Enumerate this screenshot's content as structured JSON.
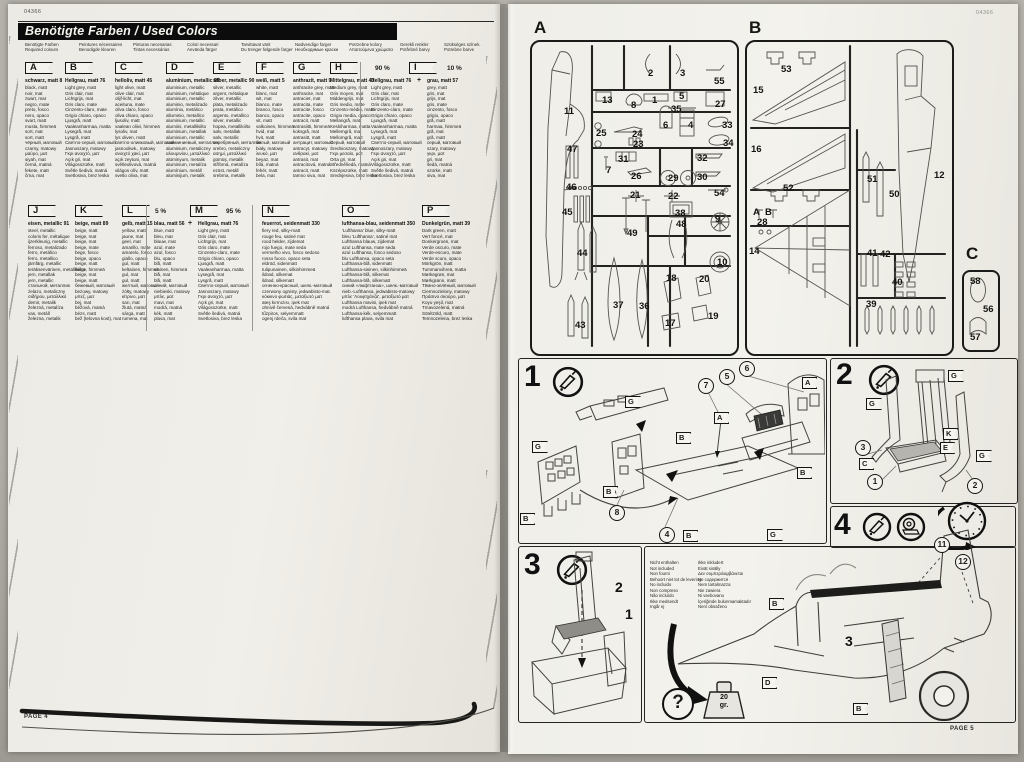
{
  "codes": {
    "left": "04366",
    "right": "04366"
  },
  "footers": {
    "left": "PAGE 4",
    "right": "PAGE 5"
  },
  "banner": {
    "title": "Benötigte Farben / Used Colors"
  },
  "header_labels": [
    {
      "a": "Benötigte Farben",
      "b": "Required colours"
    },
    {
      "a": "Peintures nécessaires",
      "b": "Benodigde kleuren"
    },
    {
      "a": "Pinturas necesarias",
      "b": "Tintas necessárias"
    },
    {
      "a": "Colori necessari",
      "b": "Använda färger"
    },
    {
      "a": "Tarvittavat värit",
      "b": "Du trenger følgende farger"
    },
    {
      "a": "Nødvendige farger",
      "b": "Необходимые краски"
    },
    {
      "a": "Potrzebne kolory",
      "b": "Απαιτούμενα χρώματα"
    },
    {
      "a": "Gerekli renkler",
      "b": "Potřebné barvy"
    },
    {
      "a": "Szükséges színek.",
      "b": "Potrebne barve"
    }
  ],
  "colors": [
    {
      "letter": "A",
      "name": "schwarz, matt 8",
      "lines": [
        "black, matt",
        "noir, mat",
        "zwart, mat",
        "negro, mate",
        "preto, fosco",
        "nero, opaco",
        "svart, matt",
        "musta, himmeä",
        "sort, mat",
        "sort, matt",
        "чёрный, матовый",
        "czarny, matowy",
        "μαύρο, ματ",
        "siyah, mat",
        "černá, matná",
        "fekete, matt",
        "črna, mat"
      ]
    },
    {
      "letter": "B",
      "name": "Hellgrau, matt 76",
      "lines": [
        "Light grey, matt",
        "Gris clair, mat",
        "Lichtgrijs, mat",
        "Gris claro, mate",
        "Cinzento-claro, mate",
        "Grigio chiaro, opaco",
        "Ljusgrå, matt",
        "Vaaleanharmaa, matta",
        "Lysegrå, mat",
        "Lysgrå, matt",
        "Светло-серый, матовый",
        "Jasnoszary, matowy",
        "Γκρι ανοιχτό, ματ",
        "Açık gri, mat",
        "Világosszürke, matt",
        "Světle šedivá, matná",
        "Svetlosiva, brez leska"
      ]
    },
    {
      "letter": "C",
      "name": "helloliv, matt 45",
      "lines": [
        "light olive, matt",
        "olive clair, mat",
        "olijf-licht, mat",
        "aceituna, mate",
        "oliva claro, fosco",
        "oliva chiaro, opaco",
        "ljusoliv, matt",
        "vaalean oliivi, himmeä",
        "lysoliv, mat",
        "lys oliven, matt",
        "светло-оливковый, матовый",
        "jasnooliwk., matowy",
        "ανοιχτό χακί, ματ",
        "açık zeytuni, mat",
        "světleolivová, matná",
        "világos olív, matt",
        "svetlo oliva, mat"
      ]
    },
    {
      "letter": "D",
      "name": "aluminium, metallic 99",
      "lines": [
        "aluminium, metallic",
        "aluminium, métalique",
        "aluminium, metallic",
        "aluminio, metalizado",
        "alumínio, metálico",
        "alluminio, metallico",
        "aluminium, metallic",
        "alumiini, metallikiilto",
        "aluminium, metallak",
        "aluminium, metallic",
        "алюминиевый, металлик",
        "aluminium, metaliczny",
        "αλουμινίου, μεταλλικό",
        "alüminyum, metalik",
        "aluminium, metalíza",
        "alumínium, metáll",
        "aluminijum, metalik"
      ]
    },
    {
      "letter": "E",
      "name": "silber, metallic 90",
      "lines": [
        "silver, metallic",
        "argent, métalique",
        "zilver, metallic",
        "plata, metalizado",
        "prata, metálico",
        "argento, metallico",
        "silver, metallic",
        "hopea, metallikiilto",
        "sølv, metallak",
        "sølv, metallic",
        "серебряный, металлик",
        "srebro, metaliczny",
        "ασημί, μεταλλικό",
        "gümüş, metalik",
        "stříbrná, metalíza",
        "ezüst, metáll",
        "srebrna, metalik"
      ]
    },
    {
      "letter": "F",
      "name": "weiß, matt 5",
      "lines": [
        "white, matt",
        "blanc, mat",
        "wit, mat",
        "blanco, mate",
        "branco, fosco",
        "bianco, opaco",
        "vit, matt",
        "valkoinen, himmeä",
        "hvid, mat",
        "hvit, matt",
        "белый, матовый",
        "biały, matowy",
        "λευκό, ματ",
        "beyaz, mat",
        "bílá, matná",
        "fehér, matt",
        "bela, mat"
      ]
    },
    {
      "letter": "G",
      "name": "anthrazit, matt 9",
      "lines": [
        "anthracite grey, matt",
        "anthracite, mat",
        "antraciet, mat",
        "antracita, mate",
        "antracite, fosco",
        "antracite, opaco",
        "antracit, matt",
        "antrasiitti, himmeä",
        "koksgrå, mat",
        "antrasitt, matt",
        "антрацит, матовый",
        "antracyt, matowy",
        "ανθρακί, ματ",
        "antrasit, mat",
        "antracitová, matná",
        "antracit, matt",
        "tamno siva, mat"
      ]
    },
    {
      "letter": "H",
      "name": "Mittelgrau, matt 43",
      "lines": [
        "Medium grey, matt",
        "Gris moyen, mat",
        "Middengrijs, mat",
        "Gris medio, mate",
        "Cinzento-médio, mate",
        "Grigio media, opaco",
        "Mellangrå, matt",
        "Keskiharmaa, matta",
        "Mellemgrå, mat",
        "Mellomgrå, matt",
        "Серый, матовый",
        "Średnioszary, matowy",
        "Γκρι μεσαίο, ματ",
        "Orta gri, mat",
        "Středněšedá, matná",
        "Középszürke, matt",
        "Srednjesiva, brez leska"
      ]
    },
    {
      "letter": "I",
      "pct_main": "90 %",
      "pct_mix": "10 %",
      "plus": "+",
      "name": "Hellgrau, matt 76",
      "name_mix": "grau, matt 57",
      "lines": [
        "Light grey, matt",
        "Gris clair, mat",
        "Lichtgrijs, mat",
        "Gris claro, mate",
        "Cinzento-claro, mate",
        "Grigio chiaro, opaco",
        "Ljusgrå, matt",
        "Vaaleanharmaa, matta",
        "Lysegrå, mat",
        "Lysgrå, matt",
        "Светло-серый, матовый",
        "Jasnoszary, matowy",
        "Γκρι ανοιχτό, ματ",
        "Açık gri, mat",
        "Világosszürke, matt",
        "Světle šedivá, matná",
        "Svetlosiva, brez leska"
      ],
      "lines_mix": [
        "grey, matt",
        "gris, mat",
        "grijs, mat",
        "gris, mate",
        "cinzento, fosco",
        "grigio, opaco",
        "grå, matt",
        "harmaa, himmeä",
        "grå, mat",
        "grå, matt",
        "серый, матовый",
        "szary, matowy",
        "γκρι, ματ",
        "gri, mat",
        "šedá, matná",
        "szürke, matt",
        "siva, mat"
      ]
    },
    {
      "letter": "J",
      "name": "eisen, metallic 91",
      "lines": [
        "steel, metallic",
        "coloris fer, métalique",
        "ijzerkleurig, metallic",
        "ferroso, metalizado",
        "ferro, metálico",
        "ferro, metallico",
        "järnfärg, metallic",
        "teräksenvärinen, metallikiilto",
        "jern, metallak",
        "jern, metallic",
        "стальной, металлик",
        "żelazo, metaliczny",
        "σιδήρου, μεταλλικό",
        "demir, metalik",
        "železná, metalíza",
        "vas, metáll",
        "železna, metalik"
      ]
    },
    {
      "letter": "K",
      "name": "beige, matt 89",
      "lines": [
        "beige, matt",
        "beige, mat",
        "beige, mat",
        "beige, mate",
        "bege, fosco",
        "beige, opaco",
        "beige, matt",
        "beige, himmeä",
        "beige, mat",
        "beige, matt",
        "бежевый, матовый",
        "beżowy, matowy",
        "μπεζ, ματ",
        "bej, mat",
        "béžová, matná",
        "bézs, matt",
        "bež (telovna kost), mat"
      ]
    },
    {
      "letter": "L",
      "name": "gelb, matt 15",
      "lines": [
        "yellow, matt",
        "jaune, mat",
        "geel, mat",
        "amarillo, mate",
        "amarelo, fosco",
        "giallo, opaco",
        "gul, matt",
        "keltainen, himmeä",
        "gul, mat",
        "gul, matt",
        "желтый, матовый",
        "żółty, matowy",
        "κίτρινο, ματ",
        "sarı, mat",
        "žlutá, matná",
        "sárga, matt",
        "rumena, mat"
      ]
    },
    {
      "letter": "M",
      "pct_mix": "5 %",
      "pct_main": "95 %",
      "plus": "+",
      "name": "Hellgrau, matt 76",
      "name_mix": "blau, matt 56",
      "lines": [
        "Light grey, matt",
        "Gris clair, mat",
        "Lichtgrijs, mat",
        "Gris claro, mate",
        "Cinzento-claro, mate",
        "Grigio chiaro, opaco",
        "Ljusgrå, matt",
        "Vaaleanharmaa, matta",
        "Lysegrå, mat",
        "Lysgrå, matt",
        "Светло-серый, матовый",
        "Jasnoszary, matowy",
        "Γκρι ανοιχτό, ματ",
        "Açık gri, mat",
        "Világosszürke, matt",
        "Světle šedivá, matná",
        "Svetlosiva, brez leska"
      ],
      "lines_mix": [
        "blue, matt",
        "bleu, mat",
        "blauw, mat",
        "azul, mate",
        "azul, fosco",
        "blu, opaco",
        "blå, matt",
        "sininen, himmeä",
        "blå, mat",
        "blå, matt",
        "синий, матовый",
        "niebieski, matowy",
        "μπλε, ματ",
        "mavi, mat",
        "modrá, matná",
        "kék, matt",
        "plava, mat"
      ]
    },
    {
      "letter": "N",
      "name": "feuerrot, seidenmatt 330",
      "lines": [
        "fiery red, silky-matt",
        "rouge feu, satiné mat",
        "rood helder, zijdemat",
        "rojo fuego, mate seda",
        "vermelho vivo, fosco sedoso",
        "rosso fuoco, opaco seta",
        "eldröd, sidenmatt",
        "tulipunainen, silkinhimmeä",
        "ildrød, silkemat",
        "ildrød, silkematt",
        "огненно-красный, шелк.-матовый",
        "czerwony ognisty, jedwabisto-mat.",
        "κόκκινο φωτιάς, μεταξωτό ματ",
        "ateş kırmızısı, ipek mat",
        "ohnivě červená, hedvábně matná",
        "tűzpiros, selyemmatt",
        "ogenj rdeča, svila mat"
      ]
    },
    {
      "letter": "O",
      "name": "lufthansa-blau, seidenmatt 350",
      "lines": [
        "'Lufthansa' blue, silky-matt",
        "bleu 'Lufthansa', satiné mat",
        "Lufthansa blauw, zijdemat",
        "azul Lufthansa, mate seda",
        "azul Lufthansa, fosco sedoso",
        "blu Lufthansa, opaco seta",
        "Lufthansa-blå, sidenmatt",
        "Lufthansa-sininen, silkinhimmeä",
        "Lufthansa-blå, silkemat",
        "Lufthansa-blå, silkematt",
        "синий «люфтганза», шелк.-матовый",
        "nieb.-Lufthansa, jedwabisto-matowy",
        "μπλε 'Λουφτχάνζα', μεταξωτό ματ",
        "Lufthansa mavisi, ipek mat",
        "modrá Lufthansa, hedvábně matná",
        "Lufthansa-kék, selyemmatt",
        "lufthansa plava, svila mat"
      ]
    },
    {
      "letter": "P",
      "name": "Dunkelgrün, matt 39",
      "lines": [
        "Dark green, matt",
        "Vert foncé, mat",
        "Donkergroen, mat",
        "Verde oscuro, mate",
        "Verde-escuro, mate",
        "Verde scuro, opaco",
        "Mörkgrön, matt",
        "Tummanvihreä, matta",
        "Mørkegrøn, mat",
        "Mørkgrønn, matt",
        "Тёмно-зелёный, матовый",
        "Ciemnozielony, matowy",
        "Πράσινο σκούρο, ματ",
        "Koyu yeşil, mat",
        "Tmavozelená, matná",
        "Sötétzöld, matt",
        "Temnozelena, brez leska"
      ]
    }
  ],
  "sprues": {
    "a": {
      "label": "A",
      "parts": [
        {
          "t": "11",
          "x": 34,
          "y": 66
        },
        {
          "t": "2",
          "x": 118,
          "y": 28
        },
        {
          "t": "3",
          "x": 150,
          "y": 28
        },
        {
          "t": "55",
          "x": 184,
          "y": 36
        },
        {
          "t": "13",
          "x": 72,
          "y": 55
        },
        {
          "t": "8",
          "x": 101,
          "y": 60
        },
        {
          "t": "1",
          "x": 122,
          "y": 55
        },
        {
          "t": "5",
          "x": 149,
          "y": 51
        },
        {
          "t": "27",
          "x": 185,
          "y": 59
        },
        {
          "t": "35",
          "x": 141,
          "y": 64
        },
        {
          "t": "25",
          "x": 66,
          "y": 88
        },
        {
          "t": "24",
          "x": 102,
          "y": 89
        },
        {
          "t": "6",
          "x": 133,
          "y": 80
        },
        {
          "t": "4",
          "x": 158,
          "y": 80
        },
        {
          "t": "33",
          "x": 192,
          "y": 80
        },
        {
          "t": "34",
          "x": 193,
          "y": 98
        },
        {
          "t": "23",
          "x": 103,
          "y": 99
        },
        {
          "t": "47",
          "x": 37,
          "y": 104
        },
        {
          "t": "31",
          "x": 88,
          "y": 114
        },
        {
          "t": "32",
          "x": 167,
          "y": 113
        },
        {
          "t": "7",
          "x": 76,
          "y": 125
        },
        {
          "t": "26",
          "x": 101,
          "y": 131
        },
        {
          "t": "29",
          "x": 138,
          "y": 133
        },
        {
          "t": "30",
          "x": 167,
          "y": 132
        },
        {
          "t": "46",
          "x": 36,
          "y": 142
        },
        {
          "t": "21",
          "x": 100,
          "y": 150
        },
        {
          "t": "22",
          "x": 138,
          "y": 151
        },
        {
          "t": "54",
          "x": 184,
          "y": 148
        },
        {
          "t": "45",
          "x": 32,
          "y": 167
        },
        {
          "t": "38",
          "x": 145,
          "y": 168
        },
        {
          "t": "9",
          "x": 185,
          "y": 174
        },
        {
          "t": "49",
          "x": 97,
          "y": 188
        },
        {
          "t": "48",
          "x": 146,
          "y": 179
        },
        {
          "t": "44",
          "x": 47,
          "y": 208
        },
        {
          "t": "10",
          "x": 187,
          "y": 217
        },
        {
          "t": "18",
          "x": 136,
          "y": 233
        },
        {
          "t": "20",
          "x": 169,
          "y": 234
        },
        {
          "t": "37",
          "x": 83,
          "y": 260
        },
        {
          "t": "36",
          "x": 109,
          "y": 261
        },
        {
          "t": "43",
          "x": 45,
          "y": 280
        },
        {
          "t": "17",
          "x": 135,
          "y": 278
        },
        {
          "t": "19",
          "x": 178,
          "y": 271
        }
      ]
    },
    "b": {
      "label": "B",
      "parts": [
        {
          "t": "53",
          "x": 36,
          "y": 24
        },
        {
          "t": "15",
          "x": 8,
          "y": 45
        },
        {
          "t": "16",
          "x": 6,
          "y": 104
        },
        {
          "t": "51",
          "x": 122,
          "y": 134
        },
        {
          "t": "50",
          "x": 144,
          "y": 149
        },
        {
          "t": "12",
          "x": 189,
          "y": 130
        },
        {
          "t": "52",
          "x": 38,
          "y": 143
        },
        {
          "t": "A",
          "x": 8,
          "y": 167
        },
        {
          "t": "B",
          "x": 20,
          "y": 167
        },
        {
          "t": "28",
          "x": 12,
          "y": 177
        },
        {
          "t": "14",
          "x": 4,
          "y": 206
        },
        {
          "t": "41",
          "x": 122,
          "y": 208
        },
        {
          "t": "42",
          "x": 135,
          "y": 209
        },
        {
          "t": "40",
          "x": 147,
          "y": 237
        },
        {
          "t": "39",
          "x": 121,
          "y": 259
        }
      ]
    },
    "c": {
      "label": "C",
      "parts": [
        {
          "t": "58",
          "x": 8,
          "y": 6
        },
        {
          "t": "56",
          "x": 21,
          "y": 34
        },
        {
          "t": "57",
          "x": 8,
          "y": 62
        }
      ]
    }
  },
  "steps": {
    "s1": {
      "num": "1",
      "circles": [
        {
          "t": "7",
          "x": 180,
          "y": 20
        },
        {
          "t": "5",
          "x": 201,
          "y": 11
        },
        {
          "t": "6",
          "x": 221,
          "y": 3
        },
        {
          "t": "8",
          "x": 91,
          "y": 147
        },
        {
          "t": "4",
          "x": 141,
          "y": 169
        }
      ],
      "flags": [
        {
          "t": "G",
          "x": 107,
          "y": 38
        },
        {
          "t": "B",
          "x": 158,
          "y": 74
        },
        {
          "t": "A",
          "x": 196,
          "y": 54
        },
        {
          "t": "A",
          "x": 284,
          "y": 19
        },
        {
          "t": "B",
          "x": 279,
          "y": 109
        },
        {
          "t": "G",
          "x": 14,
          "y": 83
        },
        {
          "t": "B",
          "x": 2,
          "y": 155
        },
        {
          "t": "B",
          "x": 85,
          "y": 128
        },
        {
          "t": "G",
          "x": 249,
          "y": 171
        },
        {
          "t": "B",
          "x": 165,
          "y": 172
        }
      ]
    },
    "s2": {
      "num": "2",
      "circles": [
        {
          "t": "3",
          "x": 25,
          "y": 82
        },
        {
          "t": "1",
          "x": 37,
          "y": 116
        },
        {
          "t": "2",
          "x": 137,
          "y": 120
        }
      ],
      "flags": [
        {
          "t": "G",
          "x": 36,
          "y": 40
        },
        {
          "t": "G",
          "x": 118,
          "y": 12
        },
        {
          "t": "K",
          "x": 113,
          "y": 70
        },
        {
          "t": "E",
          "x": 110,
          "y": 84
        },
        {
          "t": "C",
          "x": 29,
          "y": 100
        },
        {
          "t": "G",
          "x": 146,
          "y": 92
        }
      ]
    },
    "s3": {
      "num": "3",
      "plain": [
        {
          "t": "2",
          "x": 97,
          "y": 33
        },
        {
          "t": "1",
          "x": 107,
          "y": 60
        }
      ]
    },
    "s4": {
      "num": "4",
      "circles": [
        {
          "t": "11",
          "x": 290,
          "y": 31
        },
        {
          "t": "12",
          "x": 311,
          "y": 48
        }
      ],
      "flags": [
        {
          "t": "B",
          "x": 125,
          "y": 92
        },
        {
          "t": "D",
          "x": 118,
          "y": 171
        },
        {
          "t": "B",
          "x": 209,
          "y": 197
        }
      ],
      "plain": [
        {
          "t": "3",
          "x": 201,
          "y": 127
        }
      ],
      "question": "?",
      "weight_top": "20",
      "weight_bottom": "gr.",
      "not_included_col1": [
        "Nicht enthalten",
        "Not included",
        "Non fourni",
        "Behoort niet tot de levering",
        "No incluido",
        "Non compreso",
        "Não incluído",
        "Ikke medsendt",
        "Ingår ej"
      ],
      "not_included_col2": [
        "Ikke inkludert",
        "Eivät sisälly",
        "Δεν συμπεριλαμβάνεται",
        "Не содержится",
        "Nem tartalmazza",
        "Nie zawiera",
        "Ni vsebovano",
        "İçeriğinde bulunmamaktadır",
        "Není obsaženo"
      ]
    }
  }
}
